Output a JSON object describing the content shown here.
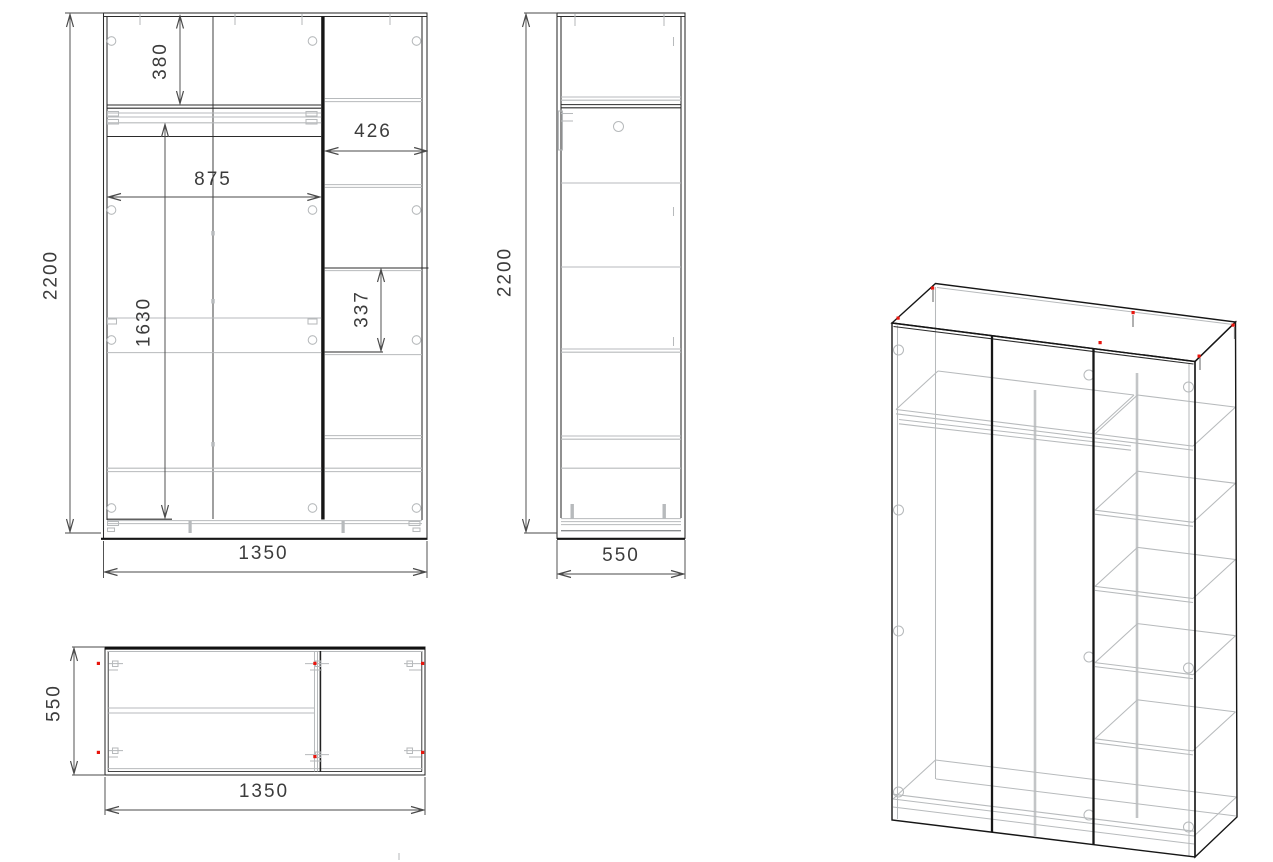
{
  "title": "Wardrobe technical drawing",
  "views": {
    "front": {
      "label": "front view",
      "dimensions": {
        "height": "2200",
        "width": "1350",
        "top_shelf_depth": "380",
        "left_section_width": "875",
        "right_section_width": "426",
        "rail_clearance": "1630",
        "shelf_spacing": "337"
      }
    },
    "side": {
      "label": "side view",
      "dimensions": {
        "height": "2200",
        "depth": "550"
      }
    },
    "plan": {
      "label": "top view",
      "dimensions": {
        "depth": "550",
        "width": "1350"
      }
    },
    "isometric": {
      "label": "3d wireframe view"
    }
  },
  "colors": {
    "background": "#ffffff",
    "line": "#2b2b2b",
    "light_line": "#b7babc",
    "dimension": "#4a4a4a",
    "hardware_accent": "#e8150d"
  }
}
